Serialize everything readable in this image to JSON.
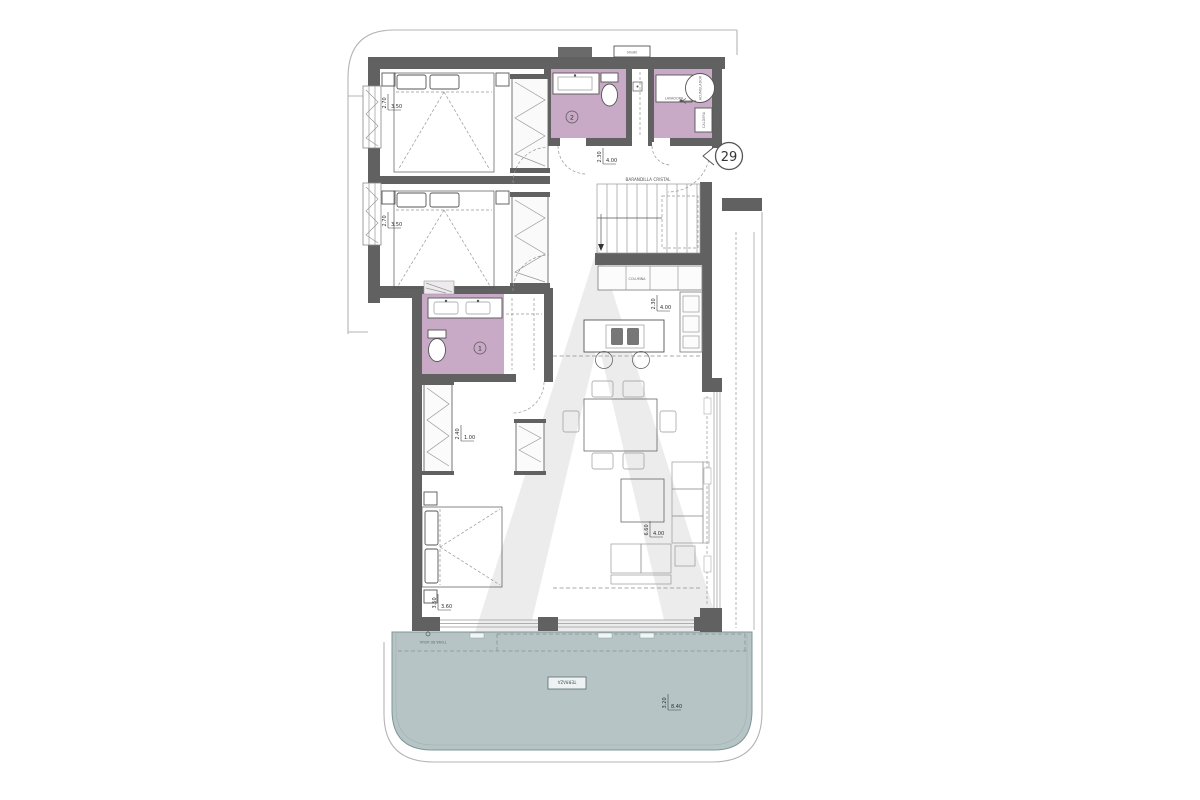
{
  "plan": {
    "entrance": {
      "unit_number": "29"
    },
    "rooms": {
      "bath1_number": "1",
      "bath2_number": "2",
      "stairs_label": "BARANDILLA CRISTAL",
      "kitchen_column_label": "COLUMNA",
      "shaft_label": "90x80",
      "terrace_label": "TERRAZA",
      "water_intake_label": "TOMA DE AGUA",
      "utility": {
        "washer": "LAVADORA",
        "heater": "ACUMULADOR",
        "boiler": "CALDERA"
      }
    },
    "dimensions": {
      "bedroom1": {
        "h": "2.70",
        "w": "3.50"
      },
      "bedroom2": {
        "h": "2.70",
        "w": "3.50"
      },
      "hall": {
        "h": "2.30",
        "w": "4.00"
      },
      "kitchen": {
        "h": "2.30",
        "w": "4.00"
      },
      "living": {
        "h": "6.60",
        "w": "4.00"
      },
      "master_entry": {
        "h": "2.40",
        "w": "1.00"
      },
      "master": {
        "h": "3.50",
        "w": "3.60"
      },
      "terrace": {
        "h": "3.20",
        "w": "8.40"
      }
    },
    "colors": {
      "wall": "#616161",
      "bathroom": "#c9aac6",
      "terrace": "#b6c4c5",
      "watermark": "#ececec"
    }
  }
}
